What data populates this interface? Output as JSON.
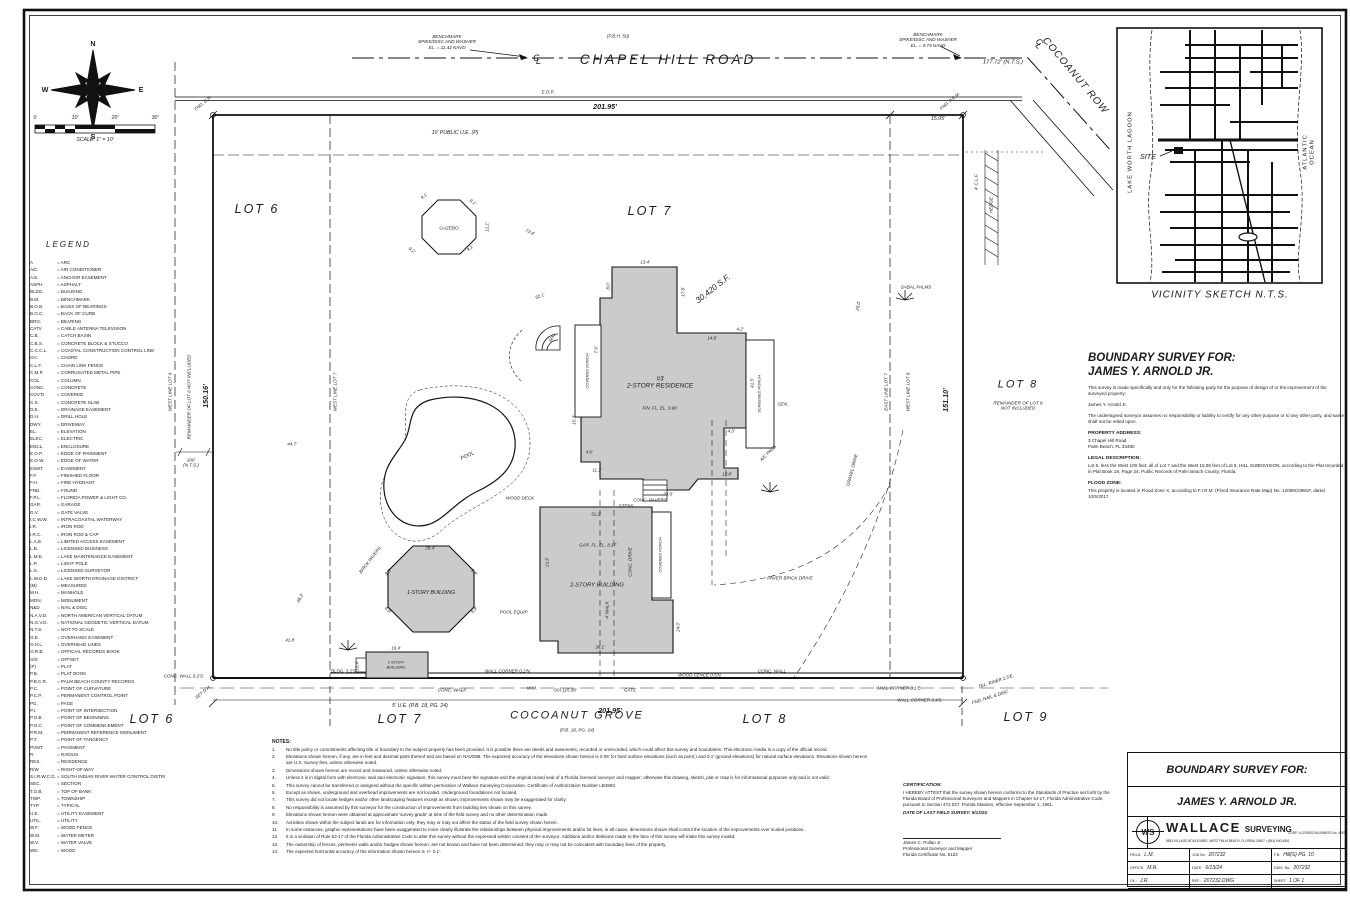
{
  "compass": {
    "n": "N",
    "e": "E",
    "s": "S",
    "w": "W"
  },
  "scalebar": {
    "t0": "0",
    "t1": "10'",
    "t2": "20'",
    "t3": "30'",
    "caption": "SCALE: 1\" = 10'"
  },
  "legend": {
    "title": "LEGEND",
    "items": [
      [
        "A",
        "ARC"
      ],
      [
        "A/C",
        "AIR CONDITIONER"
      ],
      [
        "A.E.",
        "ANCHOR EASEMENT"
      ],
      [
        "ASPH.",
        "ASPHALT"
      ],
      [
        "BLDG.",
        "BUILDING"
      ],
      [
        "B.M.",
        "BENCHMARK"
      ],
      [
        "B.O.B.",
        "BASIS OF BEARINGS"
      ],
      [
        "B.O.C.",
        "BACK OF CURB"
      ],
      [
        "BRG.",
        "BEARING"
      ],
      [
        "CATV",
        "CABLE ANTENNA TELEVISION"
      ],
      [
        "C.B.",
        "CATCH BASIN"
      ],
      [
        "C.B.S.",
        "CONCRETE BLOCK & STUCCO"
      ],
      [
        "C.C.C.L.",
        "COASTAL CONSTRUCTION CONTROL LINE"
      ],
      [
        "CH.",
        "CHORD"
      ],
      [
        "C.L.F.",
        "CHAIN LINK FENCE"
      ],
      [
        "C.M.P.",
        "CORRUGATED METAL PIPE"
      ],
      [
        "COL.",
        "COLUMN"
      ],
      [
        "CONC.",
        "CONCRETE"
      ],
      [
        "COV'D",
        "COVERED"
      ],
      [
        "C.S.",
        "CONCRETE SLAB"
      ],
      [
        "D.E.",
        "DRAINAGE EASEMENT"
      ],
      [
        "D.H.",
        "DRILL HOLE"
      ],
      [
        "DWY.",
        "DRIVEWAY"
      ],
      [
        "EL.",
        "ELEVATION"
      ],
      [
        "ELEC.",
        "ELECTRIC"
      ],
      [
        "ENCL.",
        "ENCLOSURE"
      ],
      [
        "E.O.P.",
        "EDGE OF PAVEMENT"
      ],
      [
        "E.O.W.",
        "EDGE OF WATER"
      ],
      [
        "ESMT.",
        "EASEMENT"
      ],
      [
        "F.F.",
        "FINISHED FLOOR"
      ],
      [
        "F.H.",
        "FIRE HYDRANT"
      ],
      [
        "FND.",
        "FOUND"
      ],
      [
        "F.P.L.",
        "FLORIDA POWER & LIGHT CO."
      ],
      [
        "GAR.",
        "GARAGE"
      ],
      [
        "G.V.",
        "GATE VALVE"
      ],
      [
        "I.C.W.W.",
        "INTRACOASTAL WATERWAY"
      ],
      [
        "I.R.",
        "IRON ROD"
      ],
      [
        "I.R.C.",
        "IRON ROD & CAP"
      ],
      [
        "L.A.E.",
        "LIMITED ACCESS EASEMENT"
      ],
      [
        "L.B.",
        "LICENSED BUSINESS"
      ],
      [
        "L.M.E.",
        "LAKE MAINTENANCE EASEMENT"
      ],
      [
        "L.P.",
        "LIGHT POLE"
      ],
      [
        "L.S.",
        "LICENSED SURVEYOR"
      ],
      [
        "L.W.D.D.",
        "LAKE WORTH DRAINAGE DISTRICT"
      ],
      [
        "(M)",
        "MEASURED"
      ],
      [
        "M.H.",
        "MANHOLE"
      ],
      [
        "MON.",
        "MONUMENT"
      ],
      [
        "N&D",
        "NAIL & DISC"
      ],
      [
        "N.A.V.D.",
        "NORTH AMERICAN VERTICAL DATUM"
      ],
      [
        "N.G.V.D.",
        "NATIONAL GEODETIC VERTICAL DATUM"
      ],
      [
        "N.T.S.",
        "NOT TO SCALE"
      ],
      [
        "O.E.",
        "OVERHANG EASEMENT"
      ],
      [
        "O.H.L.",
        "OVERHEAD LINES"
      ],
      [
        "O.R.B.",
        "OFFICIAL RECORDS BOOK"
      ],
      [
        "O/S",
        "OFFSET"
      ],
      [
        "(P)",
        "PLAT"
      ],
      [
        "P.B.",
        "PLAT BOOK"
      ],
      [
        "P.B.C.R.",
        "PALM BEACH COUNTY RECORDS"
      ],
      [
        "P.C.",
        "POINT OF CURVATURE"
      ],
      [
        "P.C.P.",
        "PERMANENT CONTROL POINT"
      ],
      [
        "PG.",
        "PAGE"
      ],
      [
        "P.I.",
        "POINT OF INTERSECTION"
      ],
      [
        "P.O.B.",
        "POINT OF BEGINNING"
      ],
      [
        "P.O.C.",
        "POINT OF COMMENCEMENT"
      ],
      [
        "P.R.M.",
        "PERMANENT REFERENCE MONUMENT"
      ],
      [
        "P.T.",
        "POINT OF TANGENCY"
      ],
      [
        "PVMT.",
        "PAVEMENT"
      ],
      [
        "R",
        "RADIUS"
      ],
      [
        "RES.",
        "RESIDENCE"
      ],
      [
        "R/W",
        "RIGHT-OF-WAY"
      ],
      [
        "S.I.R.W.C.D.",
        "SOUTH INDIAN RIVER WATER CONTROL DISTRICT"
      ],
      [
        "SEC.",
        "SECTION"
      ],
      [
        "T.O.B.",
        "TOP OF BANK"
      ],
      [
        "TWP.",
        "TOWNSHIP"
      ],
      [
        "TYP.",
        "TYPICAL"
      ],
      [
        "U.E.",
        "UTILITY EASEMENT"
      ],
      [
        "UTIL.",
        "UTILITY"
      ],
      [
        "W.F.",
        "WOOD FENCE"
      ],
      [
        "W.M.",
        "WATER METER"
      ],
      [
        "W.V.",
        "WATER VALVE"
      ],
      [
        "WD.",
        "WOOD"
      ]
    ]
  },
  "top": {
    "bm_left": "BENCHMARK\nSPIKE/DISC AND WASHER\nEL. = 11.42 NAVD",
    "bm_right": "BENCHMARK\nSPIKE/DISC AND WASHER\nEL. = 9.74 NAVD",
    "road_paren": "(P.B.H. 50)",
    "road": "CHAPEL HILL ROAD",
    "cl_c": "C",
    "cl_l": "L",
    "dim_201_top": "201.95'",
    "dim_15": "15.05'",
    "dim_177": "177.72' (N.T.S.)",
    "cocoanut_row": "COCOANUT ROW",
    "ue10": "10' PUBLIC U.E. (P)"
  },
  "plat": {
    "lot6": "LOT 6",
    "lot7": "LOT 7",
    "lot8": "LOT 8",
    "lot8_rem": "REMAINDER OF LOT 8\nNOT INCLUDED",
    "lot6_rem": "REMAINDER OF LOT 6 NOT INCLUDED",
    "west_line_6": "WEST LINE LOT 6",
    "west_line_7": "WEST LINE LOT 7",
    "east_line_7": "EAST LINE LOT 7",
    "west_line_8": "WEST LINE LOT 8",
    "dim_west": "150.16'",
    "dim_east": "151.10'",
    "dim_100": "100'\n(N.T.S.)",
    "sf": "30,420 S.F.",
    "residence": "#3\n2-STORY RESIDENCE",
    "bldg2": "2-STORY BUILDING",
    "bldg1_oct": "1-STORY BUILDING",
    "bldg1_sm": "1-STORY\nBUILDING",
    "gazebo": "GAZEBO",
    "pool": "POOL",
    "porch_left": "COVERED PORCH",
    "porch_right": "SCREENED PORCH",
    "porch2": "COVERED PORCH",
    "drive": "PAVER BRICK DRIVE",
    "microlabels": [
      {
        "t": "9.1'",
        "x": 424,
        "y": 196,
        "r": -38
      },
      {
        "t": "9.1'",
        "x": 473,
        "y": 202,
        "r": 38
      },
      {
        "t": "9.2'",
        "x": 412,
        "y": 250,
        "r": 38
      },
      {
        "t": "9.1'",
        "x": 470,
        "y": 248,
        "r": -38
      },
      {
        "t": "12.1'",
        "x": 487,
        "y": 227,
        "r": -90
      },
      {
        "t": "13.4'",
        "x": 645,
        "y": 262,
        "r": 0
      },
      {
        "t": "8.0'",
        "x": 608,
        "y": 286,
        "r": -90
      },
      {
        "t": "17.8'",
        "x": 683,
        "y": 292,
        "r": -90
      },
      {
        "t": "14.8'",
        "x": 712,
        "y": 338,
        "r": 0
      },
      {
        "t": "4.2'",
        "x": 740,
        "y": 329,
        "r": 0
      },
      {
        "t": "41.5'",
        "x": 752,
        "y": 383,
        "r": -90
      },
      {
        "t": "4.3'",
        "x": 731,
        "y": 431,
        "r": 0
      },
      {
        "t": "12.8'",
        "x": 727,
        "y": 474,
        "r": 0
      },
      {
        "t": "23.0'",
        "x": 668,
        "y": 494,
        "r": 0
      },
      {
        "t": "11.1'",
        "x": 597,
        "y": 470,
        "r": 0
      },
      {
        "t": "4.6'",
        "x": 589,
        "y": 452,
        "r": 0
      },
      {
        "t": "10.3'",
        "x": 574,
        "y": 420,
        "r": -90
      },
      {
        "t": "7.9'",
        "x": 596,
        "y": 350,
        "r": -90
      },
      {
        "t": "STEPS",
        "x": 626,
        "y": 506,
        "r": 0
      },
      {
        "t": "FIN. FL. EL. 9.66'",
        "x": 660,
        "y": 408,
        "r": 0
      },
      {
        "t": "CONC. PAVERS",
        "x": 650,
        "y": 500,
        "r": 0
      },
      {
        "t": "GAR. FL. EL. 8.17'",
        "x": 598,
        "y": 545,
        "r": 0
      },
      {
        "t": "31.2'",
        "x": 596,
        "y": 514,
        "r": 0
      },
      {
        "t": "21.0'",
        "x": 547,
        "y": 562,
        "r": -90
      },
      {
        "t": "36.1'",
        "x": 600,
        "y": 647,
        "r": 0
      },
      {
        "t": "24.0'",
        "x": 678,
        "y": 627,
        "r": -90
      },
      {
        "t": "POOL EQUIP.",
        "x": 514,
        "y": 612,
        "r": 0
      },
      {
        "t": "A/C PADS",
        "x": 768,
        "y": 453,
        "r": -45
      },
      {
        "t": "GEN.",
        "x": 783,
        "y": 404,
        "r": 0
      },
      {
        "t": "WOOD DECK",
        "x": 520,
        "y": 498,
        "r": 0
      },
      {
        "t": "BRICK PAVERS",
        "x": 370,
        "y": 560,
        "r": -52
      },
      {
        "t": "28.4'",
        "x": 430,
        "y": 548,
        "r": 0
      },
      {
        "t": "9.8'",
        "x": 388,
        "y": 572,
        "r": -45
      },
      {
        "t": "9.8'",
        "x": 474,
        "y": 572,
        "r": 45
      },
      {
        "t": "9.9'",
        "x": 388,
        "y": 610,
        "r": 45
      },
      {
        "t": "9.8'",
        "x": 474,
        "y": 610,
        "r": -45
      },
      {
        "t": "16.4'",
        "x": 396,
        "y": 648,
        "r": 0
      },
      {
        "t": "10.4'",
        "x": 357,
        "y": 666,
        "r": -90
      },
      {
        "t": "CONC. WALL 6.2'S.",
        "x": 184,
        "y": 676,
        "r": 0
      },
      {
        "t": "BLDG. 3.2'S.",
        "x": 344,
        "y": 671,
        "r": 0
      },
      {
        "t": "WALL CORNER 0.2'N.",
        "x": 508,
        "y": 671,
        "r": 0
      },
      {
        "t": "WOOD FENCE 0.5'N.",
        "x": 700,
        "y": 675,
        "r": 0
      },
      {
        "t": "CONC. WALL",
        "x": 772,
        "y": 671,
        "r": 0
      },
      {
        "t": "WALL CORNER 3.1'E.",
        "x": 899,
        "y": 688,
        "r": 0
      },
      {
        "t": "WALL CORNER 3.4'S.",
        "x": 920,
        "y": 700,
        "r": 0
      },
      {
        "t": "O/A 115.09'",
        "x": 565,
        "y": 690,
        "r": 0
      },
      {
        "t": "CONC. WALK",
        "x": 452,
        "y": 690,
        "r": 0
      },
      {
        "t": "GATE",
        "x": 630,
        "y": 690,
        "r": 0
      },
      {
        "t": "W.M.",
        "x": 532,
        "y": 688,
        "r": 0
      },
      {
        "t": "TEL. RISER 1.5'E.",
        "x": 996,
        "y": 681,
        "r": -18
      },
      {
        "t": "SABAL PALMS",
        "x": 916,
        "y": 287,
        "r": 0
      },
      {
        "t": "HEDGE",
        "x": 991,
        "y": 205,
        "r": -90
      },
      {
        "t": "4' C.L.F.",
        "x": 976,
        "y": 182,
        "r": -90
      },
      {
        "t": "FND. D.H.",
        "x": 203,
        "y": 103,
        "r": -40
      },
      {
        "t": "FND. P.R.M.",
        "x": 950,
        "y": 101,
        "r": -40
      },
      {
        "t": "FND. NAIL & DISC",
        "x": 990,
        "y": 697,
        "r": -18
      },
      {
        "t": "SET D.H.",
        "x": 203,
        "y": 692,
        "r": -40
      },
      {
        "t": "46.2'",
        "x": 300,
        "y": 598,
        "r": -62
      },
      {
        "t": "41.8'",
        "x": 290,
        "y": 640,
        "r": 0
      },
      {
        "t": "44.7'",
        "x": 292,
        "y": 444,
        "r": 0
      },
      {
        "t": "73.4'",
        "x": 530,
        "y": 232,
        "r": 28
      },
      {
        "t": "52.1'",
        "x": 540,
        "y": 296,
        "r": -20
      },
      {
        "t": "25.0'",
        "x": 858,
        "y": 306,
        "r": -80
      },
      {
        "t": "GRAVEL DRIVE",
        "x": 852,
        "y": 470,
        "r": -75
      },
      {
        "t": "CONC. DRIVE",
        "x": 630,
        "y": 562,
        "r": -90
      },
      {
        "t": "4' WALK",
        "x": 607,
        "y": 610,
        "r": -90
      },
      {
        "t": "SPA",
        "x": 552,
        "y": 338,
        "r": -55
      },
      {
        "t": "E.O.P.",
        "x": 548,
        "y": 92,
        "r": 0
      }
    ]
  },
  "bottom": {
    "dim_201": "201.95'",
    "ue5": "5' U.E. (P.B. 18, PG. 24)",
    "grove": "COCOANUT GROVE",
    "grove_pb": "(P.B. 18, PG. 24)",
    "lot6": "LOT 6",
    "lot7": "LOT 7",
    "lot8": "LOT 8",
    "lot9": "LOT 9"
  },
  "vicinity": {
    "lagoon": "LAKE WORTH LAGOON",
    "ocean": "ATLANTIC OCEAN",
    "site": "SITE",
    "caption": "VICINITY  SKETCH  N.T.S."
  },
  "info": {
    "title1": "BOUNDARY SURVEY FOR:",
    "title2": "JAMES Y. ARNOLD JR.",
    "p1": "This survey is made specifically and only for the following party for the purpose of design of or the improvement of the surveyed property:",
    "p2": "James Y. Arnold Jr.",
    "p3": "The undersigned surveyor assumes no responsibility or liability to certify for any other purpose or to any other party, and same shall not be relied upon.",
    "addr_h": "PROPERTY ADDRESS:",
    "addr1": "3 Chapel Hill Road",
    "addr2": "Palm Beach, FL 33480",
    "legal_h": "LEGAL DESCRIPTION:",
    "legal": "Lot 6, less the West 100 feet; all of Lot 7 and the West 15.05 feet of Lot 8, HILL SUBDIVISION, according to the Plat recorded in Plat Book 18, Page 24, Public Records of Palm Beach County, Florida.",
    "flood_h": "FLOOD ZONE:",
    "flood": "This property is located in Flood Zone X, according to F.I.R.M. (Flood Insurance Rate Map) No. 12099C0981F, dated 10/5/2017."
  },
  "notes": {
    "title": "NOTES:",
    "items": [
      "No title policy or commitments affecting title or boundary to the subject property has been provided. It is possible there are deeds and easements, recorded or unrecorded, which could affect this survey and boundaries. This electronic media is a copy of the official record.",
      "Elevations shown hereon, if any, are in feet and decimal parts thereof and are based on NAVD88. The expected accuracy of the elevations shown hereon is 0.05' for hard surface elevations (such as pvmt.) and 0.1' (ground elevations) for natural surface elevations. Elevations shown hereon are U.S. Survey feet, unless otherwise noted.",
      "Dimensions shown hereon are record and measured, unless otherwise noted.",
      "Unless it is in digital form with electronic seal and electronic signature, this survey must bear the signature and the original raised seal of a Florida licensed surveyor and mapper; otherwise this drawing, sketch, plat or map is for informational purposes only and is not valid.",
      "This survey cannot be transferred or assigned without the specific written permission of Wallace Surveying Corporation. Certificate of Authorization Number LB4993.",
      "Except as shown, underground and overhead improvements are not located. Underground foundations not located.",
      "This survey did not locate hedges and/or other landscaping features except as shown; improvements shown may be exaggerated for clarity.",
      "No responsibility is assumed by this surveyor for the construction of improvements from building ties shown on this survey.",
      "Elevations shown hereon were obtained at approximate 'survey grade' at time of the field survey and no other determination made.",
      "Activities shown within the subject lands are for information only; they may or may not affect the status of the field survey shown herein.",
      "In some instances, graphic representations have been exaggerated to more clearly illustrate the relationships between physical improvements and/or lot lines; in all cases, dimensions shown shall control the location of the improvements over scaled positions.",
      "It is a violation of Rule 5J-17 of the Florida Administrative Code to alter this survey without the expressed written consent of the surveyor. Additions and/or deletions made to the face of this survey will make this survey invalid.",
      "The ownership of fences, perimeter walls and/or hedges shown hereon, are not known and have not been determined; they may or may not be coincident with boundary lines of the property.",
      "The expected horizontal accuracy of the information shown hereon is +/- 0.1'."
    ]
  },
  "cert": {
    "h": "CERTIFICATION:",
    "body": "I HEREBY ATTEST that the survey shown hereon conforms to the Standards of Practice set forth by the Florida Board of Professional Surveyors and Mappers in Chapter 5J-17, Florida Administrative Code, pursuant to Section 472.027, Florida Statutes, effective September 1, 1981.",
    "date": "DATE OF LAST FIELD SURVEY: 6/13/24",
    "name": "James C. Pollan Jr.",
    "role": "Professional Surveyor and Mapper",
    "lic": "Florida Certificate No. 5122"
  },
  "title_block": {
    "header": "BOUNDARY SURVEY FOR:",
    "client": "JAMES Y. ARNOLD JR.",
    "logo": {
      "ws": "WS",
      "name": "WALLACE",
      "name2": "SURVEYING",
      "sub": "CORP.  LICENSED BUSINESS No. 4993",
      "address": "5553 VILLAGE BOULEVARD, WEST PALM BEACH, FLORIDA 33407 • (561) 640-4551"
    },
    "cells": [
      {
        "k": "FIELD:",
        "v": "L.M."
      },
      {
        "k": "JOB No.",
        "v": "207232"
      },
      {
        "k": "F.B.",
        "v": "Hill(S)   PG. 10"
      },
      {
        "k": "OFFICE:",
        "v": "M.R."
      },
      {
        "k": "DATE:",
        "v": "6/13/24"
      },
      {
        "k": "DWG. No.",
        "v": "207232"
      },
      {
        "k": "CK.:",
        "v": "J.R."
      },
      {
        "k": "REF.:",
        "v": "207232.DWG"
      },
      {
        "k": "SHEET",
        "v": "1   OF   1"
      }
    ]
  }
}
